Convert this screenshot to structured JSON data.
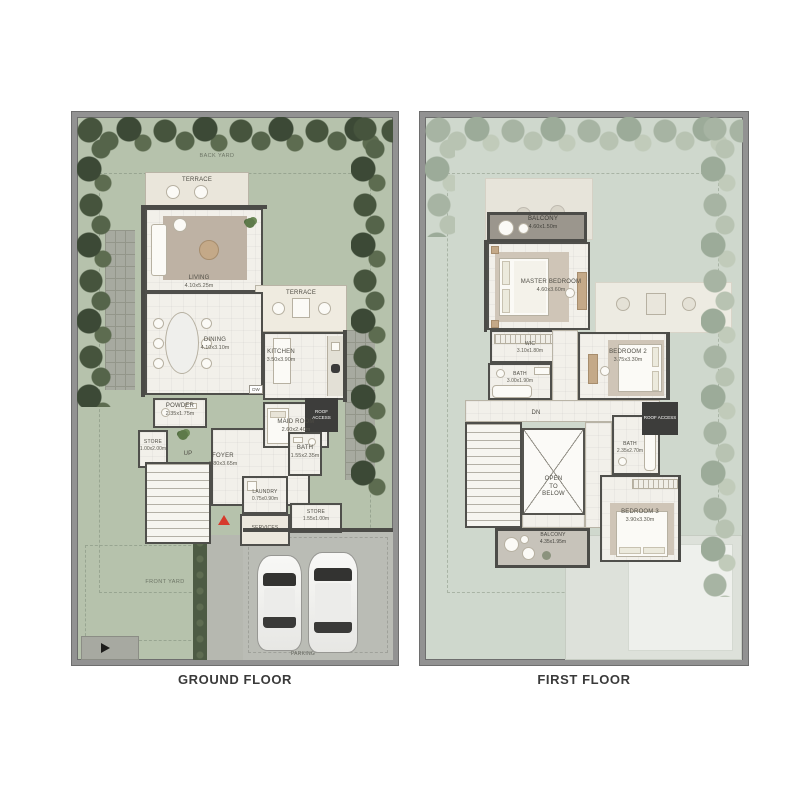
{
  "ground_floor": {
    "caption": "GROUND FLOOR",
    "back_yard": "BACK YARD",
    "front_yard": "FRONT YARD",
    "parking": "PARKING",
    "terrace_top": "TERRACE",
    "terrace_side": "TERRACE",
    "living": {
      "name": "LIVING",
      "dims": "4.10x5.25m"
    },
    "dining": {
      "name": "DINING",
      "dims": "4.10x3.10m"
    },
    "kitchen": {
      "name": "KITCHEN",
      "dims": "3.50x3.90m"
    },
    "powder": {
      "name": "POWDER",
      "dims": "2.35x1.75m"
    },
    "store1": {
      "name": "STORE",
      "dims": "1.00x2.00m"
    },
    "up": "UP",
    "dw": "DW",
    "foyer": {
      "name": "FOYER",
      "dims": "1.80x3.65m"
    },
    "maid_room": {
      "name": "MAID ROOM",
      "dims": "2.60x2.40m"
    },
    "roof_access": "ROOF ACCESS",
    "bath": {
      "name": "BATH",
      "dims": "1.55x2.35m"
    },
    "laundry": {
      "name": "LAUNDRY",
      "dims": "0.75x0.90m"
    },
    "services": "SERVICES",
    "store2": {
      "name": "STORE",
      "dims": "1.55x1.00m"
    }
  },
  "first_floor": {
    "caption": "FIRST FLOOR",
    "balcony_top": {
      "name": "BALCONY",
      "dims": "4.60x1.50m"
    },
    "master_bedroom": {
      "name": "MASTER BEDROOM",
      "dims": "4.60x3.60m"
    },
    "wic": {
      "name": "WIC",
      "dims": "3.10x1.80m"
    },
    "bath1": {
      "name": "BATH",
      "dims": "3.00x1.90m"
    },
    "bedroom2": {
      "name": "BEDROOM 2",
      "dims": "3.75x3.30m"
    },
    "dn": "DN",
    "open_to_below": "OPEN\nTO\nBELOW",
    "bath2": {
      "name": "BATH",
      "dims": "2.35x2.70m"
    },
    "roof_access": "ROOF ACCESS",
    "bedroom3": {
      "name": "BEDROOM 3",
      "dims": "3.90x3.30m"
    },
    "balcony_bottom": {
      "name": "BALCONY",
      "dims": "4.35x1.95m"
    }
  },
  "colors": {
    "grass": "#b6c2ac",
    "trees": "#4b5941",
    "first_floor_ground": "#cfd8cd",
    "faded_trees": "#abb8a8",
    "walls": "#4b4b47",
    "floor": "#f2f0ea",
    "terrace": "#eae6db",
    "balcony": "#9b968d",
    "parking": "#babcb5",
    "entrance_marker": "#d63a2c"
  }
}
